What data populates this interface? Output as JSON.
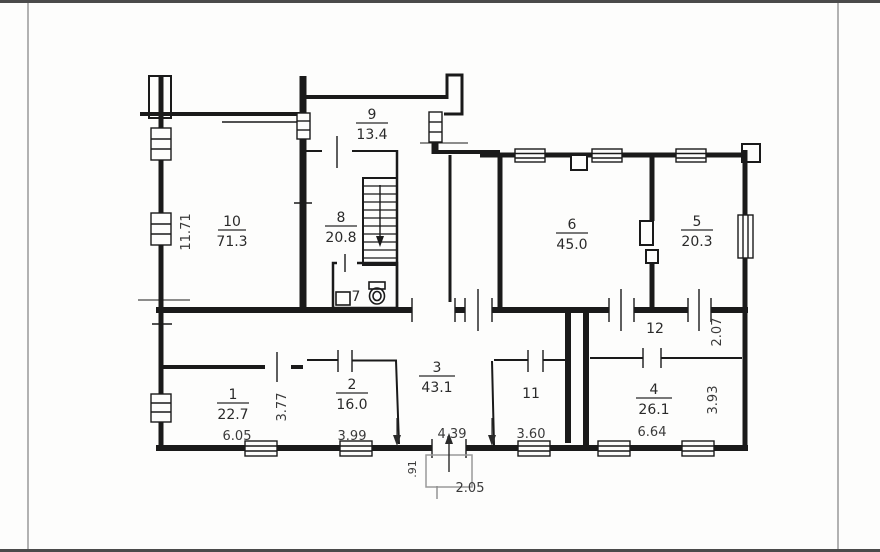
{
  "rooms": [
    {
      "id": "room-10",
      "number": "10",
      "area": "71.3"
    },
    {
      "id": "room-9",
      "number": "9",
      "area": "13.4"
    },
    {
      "id": "room-8",
      "number": "8",
      "area": "20.8"
    },
    {
      "id": "room-7",
      "number": "7"
    },
    {
      "id": "room-6",
      "number": "6",
      "area": "45.0"
    },
    {
      "id": "room-5",
      "number": "5",
      "area": "20.3"
    },
    {
      "id": "room-12",
      "number": "12"
    },
    {
      "id": "room-11",
      "number": "11"
    },
    {
      "id": "room-4",
      "number": "4",
      "area": "26.1"
    },
    {
      "id": "room-3",
      "number": "3",
      "area": "43.1"
    },
    {
      "id": "room-2",
      "number": "2",
      "area": "16.0"
    },
    {
      "id": "room-1",
      "number": "1",
      "area": "22.7"
    }
  ],
  "dimensions": {
    "left_wall_height": "11.71",
    "room1_width": "6.05",
    "room1_depth": "3.77",
    "room2_width": "3.99",
    "entry_width": "4.39",
    "room11_width": "3.60",
    "room4_width": "6.64",
    "room4_depth": "3.93",
    "room12_depth": "2.07",
    "porch_width": "2.05",
    "porch_depth": ".91"
  },
  "colors": {
    "wall": "#1a1a1a",
    "dim_text": "#3a3a3a",
    "porch_text": "#8c8c8c",
    "accent_red": "#c4524e"
  }
}
